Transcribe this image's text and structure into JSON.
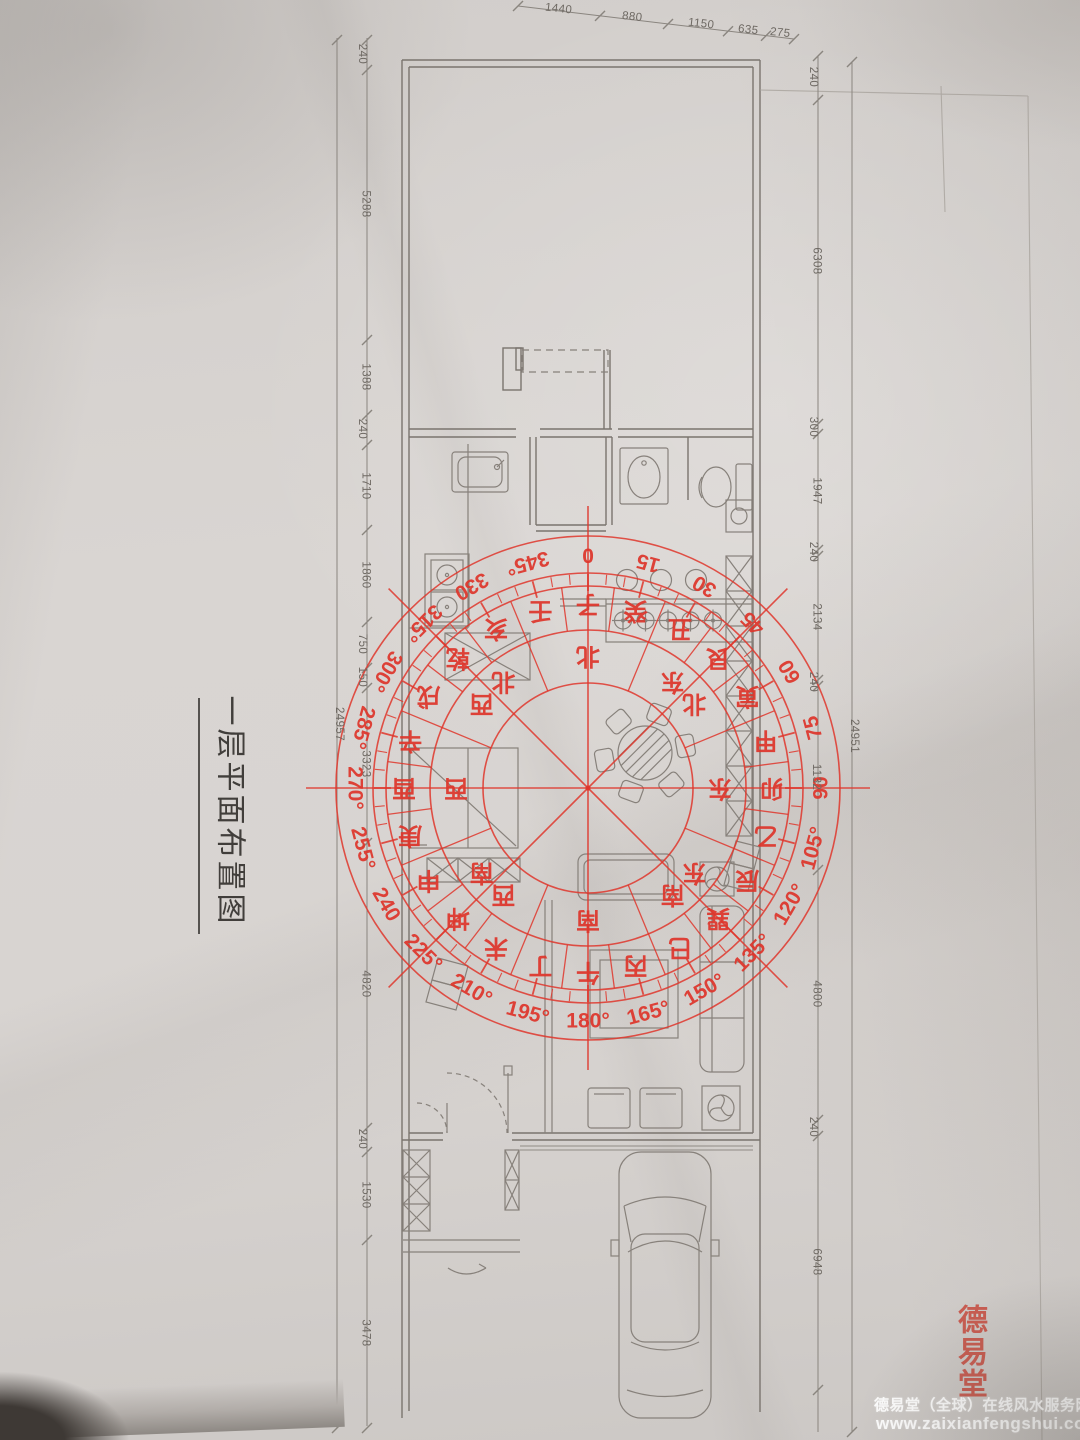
{
  "title": {
    "text": "一层平面布置图"
  },
  "compass": {
    "accent_color": "#e0382e",
    "degree_labels": [
      "0",
      "15",
      "30",
      "45",
      "60",
      "75",
      "90",
      "105°",
      "120°",
      "135°",
      "150°",
      "165°",
      "180°",
      "195°",
      "210°",
      "225°",
      "240",
      "255°",
      "270°",
      "285°",
      "300°",
      "315°",
      "330",
      "345°"
    ],
    "mountain_ring": [
      "子",
      "癸",
      "丑",
      "艮",
      "寅",
      "甲",
      "卯",
      "乙",
      "辰",
      "巽",
      "巳",
      "丙",
      "午",
      "丁",
      "未",
      "坤",
      "申",
      "庚",
      "酉",
      "辛",
      "戌",
      "乾",
      "亥",
      "壬"
    ],
    "direction_labels": [
      "北",
      "东北",
      "东",
      "东南",
      "南",
      "西南",
      "西",
      "西北"
    ]
  },
  "dimensions": {
    "top": [
      "1440",
      "880",
      "1150",
      "635",
      "275"
    ],
    "left_total": "24957",
    "left_segments": [
      "240",
      "5288",
      "1388",
      "240",
      "1710",
      "1860",
      "750",
      "150",
      "3323",
      "4820",
      "240",
      "1530",
      "3478"
    ],
    "right_total": "24951",
    "right_segments": [
      "240",
      "6308",
      "300",
      "1947",
      "240",
      "2134",
      "240",
      "1132",
      "4800",
      "240",
      "6948"
    ]
  },
  "watermark": {
    "seal_text": "德易堂",
    "line1": "德易堂（全球）在线风水服务网",
    "line2": "www.zaixianfengshui.com"
  }
}
